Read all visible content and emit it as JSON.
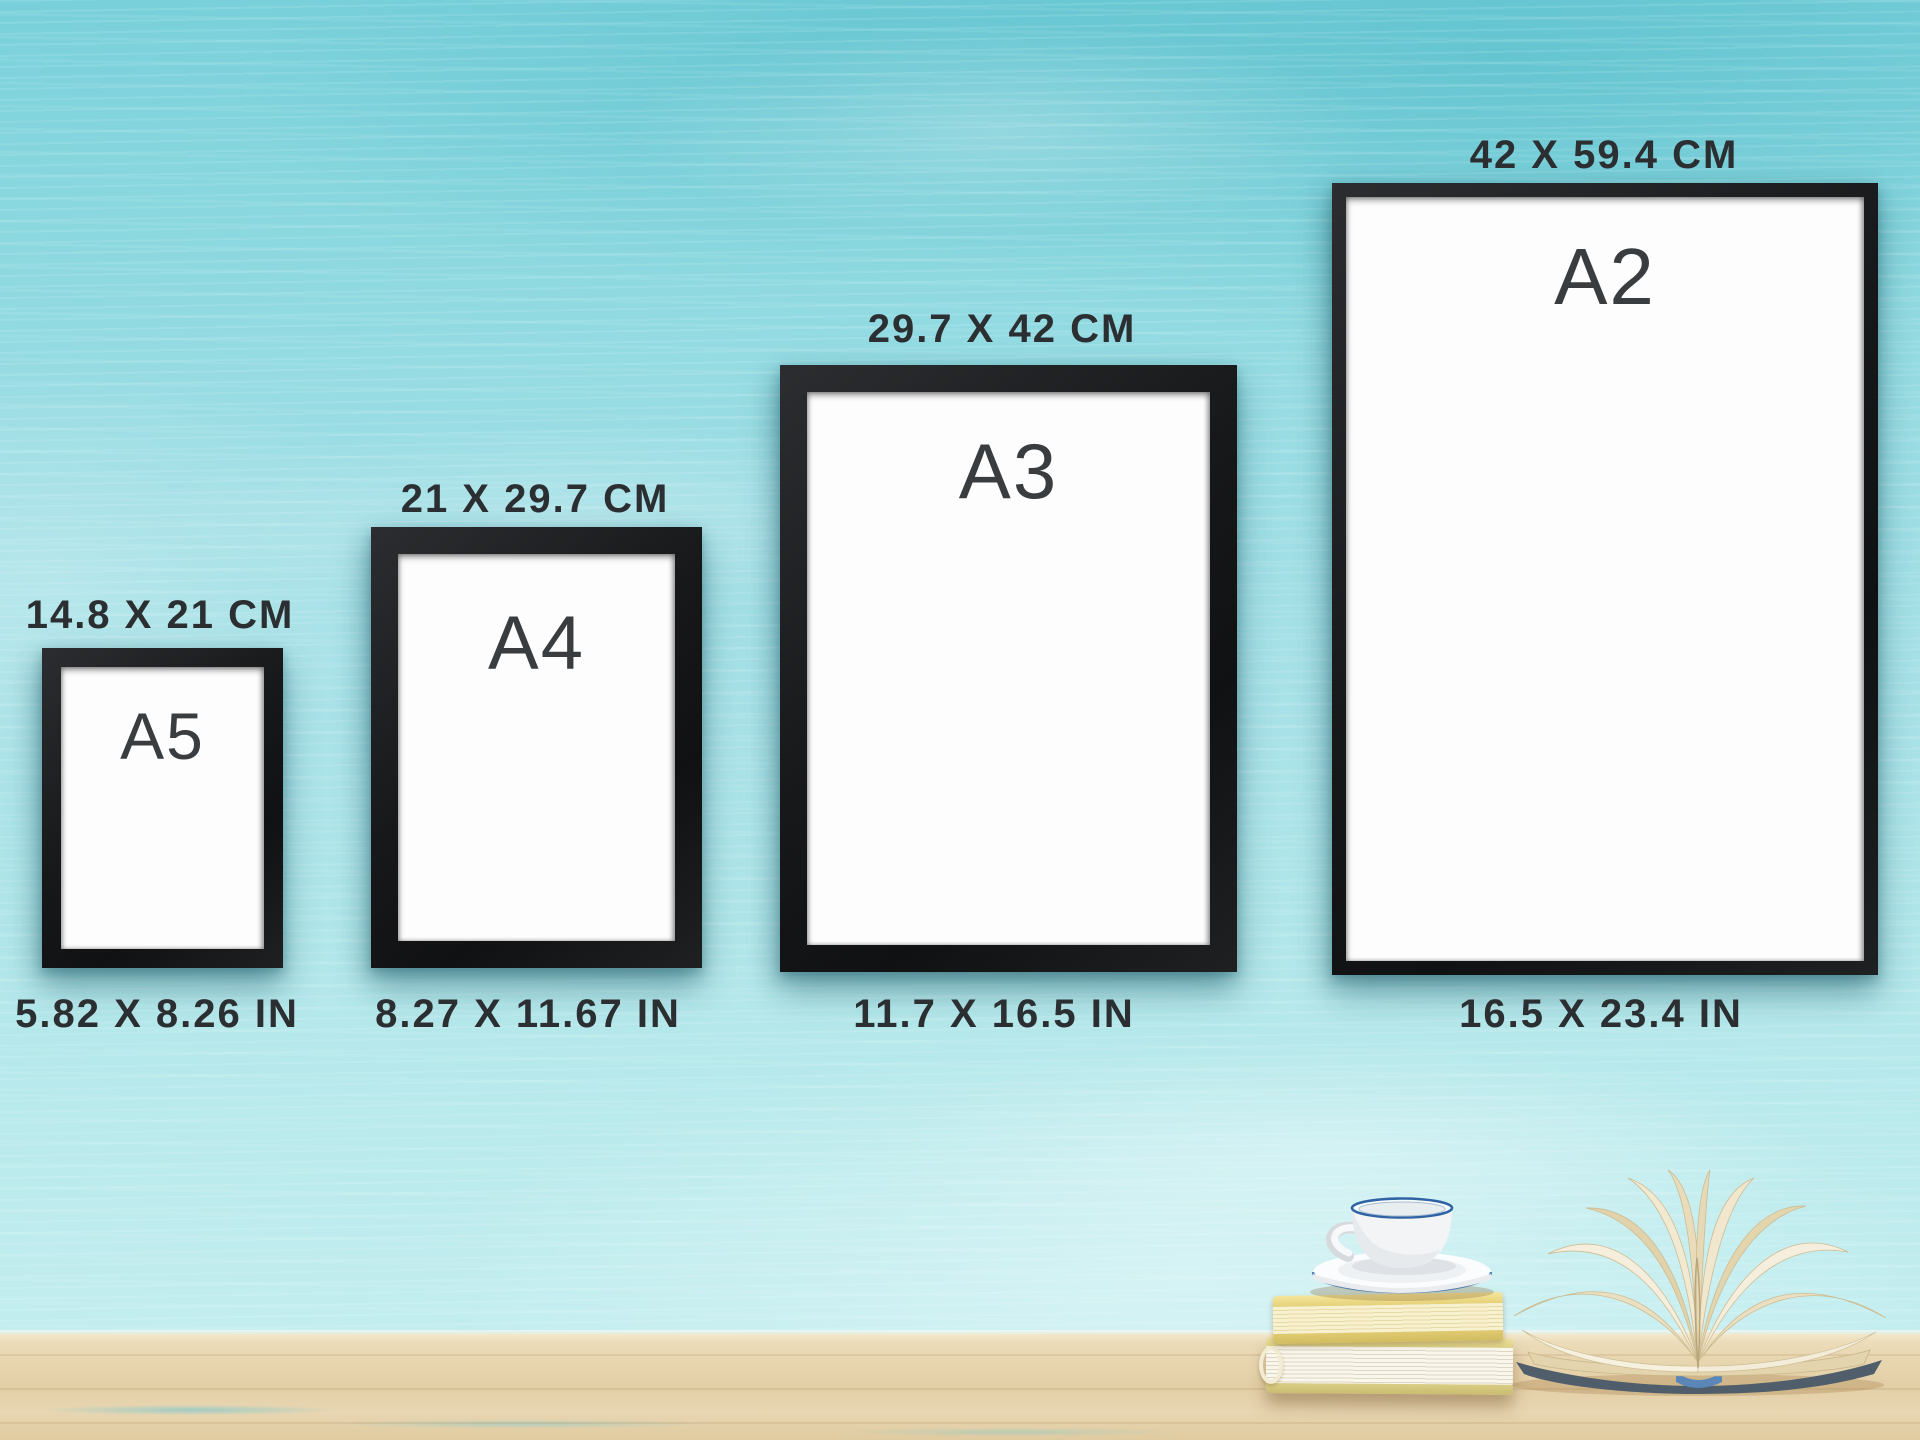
{
  "page": {
    "description": "A-series poster frame size comparison chart on a turquoise painted wall"
  },
  "frames": [
    {
      "name": "A5",
      "cm_label": "14.8 X 21 CM",
      "in_label": "5.82 X 8.26 IN"
    },
    {
      "name": "A4",
      "cm_label": "21 X 29.7 CM",
      "in_label": "8.27 X 11.67 IN"
    },
    {
      "name": "A3",
      "cm_label": "29.7 X 42 CM",
      "in_label": "11.7 X 16.5 IN"
    },
    {
      "name": "A2",
      "cm_label": "42 X 59.4 CM",
      "in_label": "16.5 X 23.4 IN"
    }
  ],
  "colors": {
    "wall_turquoise": "#9bdde4",
    "frame_black": "#17181a",
    "label_charcoal": "#2c2f32",
    "table_wood": "#e7d4ae",
    "cup_rim_blue": "#2f63a4",
    "book_yellow": "#ecdf8f",
    "open_book_cover": "#4f5e6a"
  },
  "decor": [
    {
      "name": "coffee-cup-on-saucer"
    },
    {
      "name": "stacked-books"
    },
    {
      "name": "open-book"
    }
  ]
}
